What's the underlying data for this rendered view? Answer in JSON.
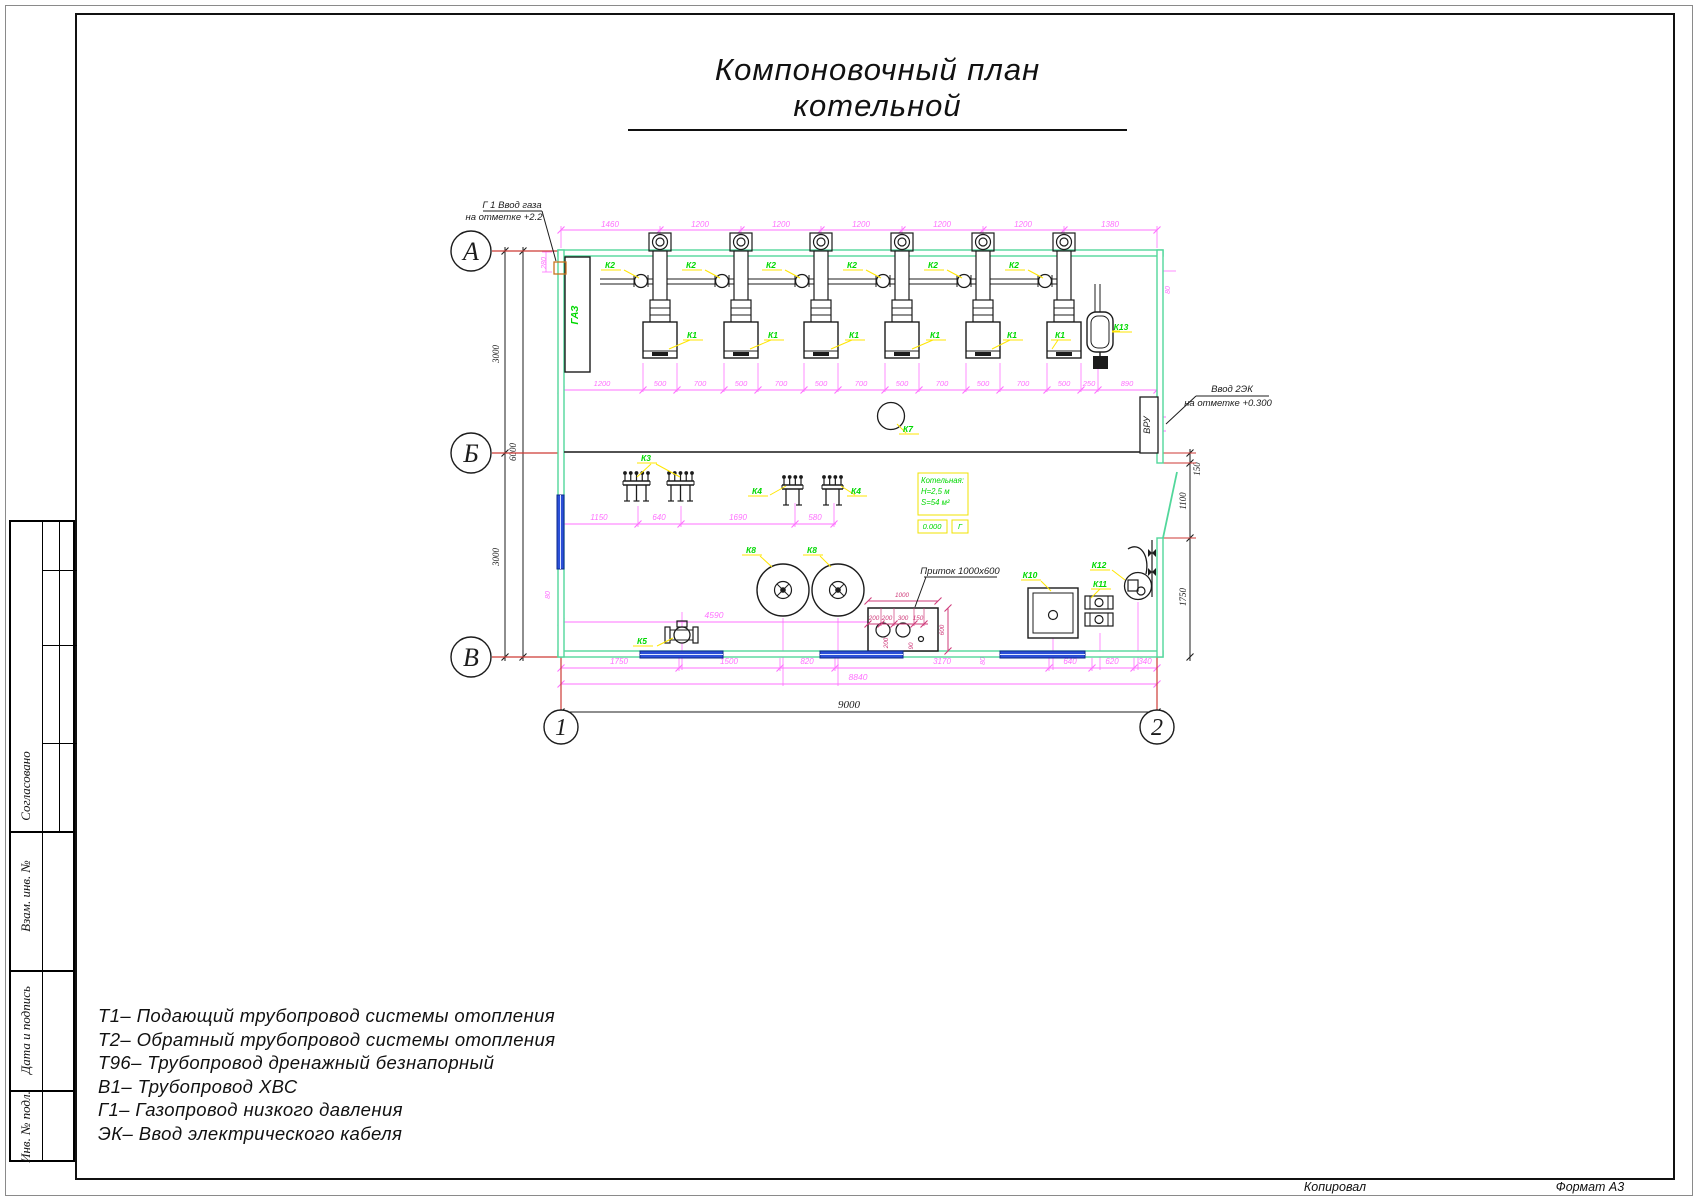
{
  "title": "Компоновочный план котельной",
  "axis_labels": {
    "rows": [
      "А",
      "Б",
      "В"
    ],
    "cols": [
      "1",
      "2"
    ]
  },
  "annotations": {
    "gas_line1": "Г 1 Ввод газа",
    "gas_line2": "на отметке +2.2",
    "cable_line1": "Ввод 2ЭК",
    "cable_line2": "на отметке +0.300",
    "intake": "Приток 1000х600",
    "gaz_cabinet": "ГАЗ",
    "vru": "ВРУ"
  },
  "room_info": {
    "name": "Котельная:",
    "height": "Н=2,5 м",
    "area": "S=54 м²",
    "level": "0.000",
    "letter": "Г"
  },
  "dims": {
    "top": [
      {
        "v": "1460",
        "x": 610
      },
      {
        "v": "1200",
        "x": 700
      },
      {
        "v": "1200",
        "x": 781
      },
      {
        "v": "1200",
        "x": 861
      },
      {
        "v": "1200",
        "x": 942
      },
      {
        "v": "1200",
        "x": 1023
      },
      {
        "v": "1380",
        "x": 1110
      }
    ],
    "boiler_row": [
      {
        "v": "1200",
        "x": 602
      },
      {
        "v": "500",
        "x": 660
      },
      {
        "v": "700",
        "x": 700
      },
      {
        "v": "500",
        "x": 741
      },
      {
        "v": "700",
        "x": 781
      },
      {
        "v": "500",
        "x": 821
      },
      {
        "v": "700",
        "x": 861
      },
      {
        "v": "500",
        "x": 902
      },
      {
        "v": "700",
        "x": 942
      },
      {
        "v": "500",
        "x": 983
      },
      {
        "v": "700",
        "x": 1023
      },
      {
        "v": "500",
        "x": 1064
      },
      {
        "v": "250",
        "x": 1089
      },
      {
        "v": "890",
        "x": 1127
      }
    ],
    "mid_row": [
      {
        "v": "1150",
        "x": 599
      },
      {
        "v": "640",
        "x": 659
      },
      {
        "v": "1690",
        "x": 738
      },
      {
        "v": "580",
        "x": 815
      }
    ],
    "single": [
      {
        "v": "4590",
        "x": 714,
        "y": 618
      },
      {
        "v": "8840",
        "x": 858,
        "y": 680
      }
    ],
    "bottom_row": [
      {
        "v": "1750",
        "x": 619
      },
      {
        "v": "1500",
        "x": 729
      },
      {
        "v": "820",
        "x": 807
      },
      {
        "v": "3170",
        "x": 942
      },
      {
        "v": "640",
        "x": 1070
      },
      {
        "v": "620",
        "x": 1112
      },
      {
        "v": "340",
        "x": 1145
      }
    ],
    "magenta_rot": [
      {
        "v": "280",
        "x": 546,
        "y": 263
      },
      {
        "v": "80",
        "x": 1170,
        "y": 290
      },
      {
        "v": "80",
        "x": 550,
        "y": 595
      },
      {
        "v": "80",
        "x": 985,
        "y": 661
      }
    ],
    "intake_dims": [
      {
        "v": "1000",
        "x": 902,
        "y": 597
      },
      {
        "v": "200",
        "x": 874,
        "y": 620
      },
      {
        "v": "200",
        "x": 887,
        "y": 620
      },
      {
        "v": "300",
        "x": 903,
        "y": 620
      },
      {
        "v": "150",
        "x": 918,
        "y": 620
      }
    ],
    "intake_rot": [
      {
        "v": "600",
        "x": 944,
        "y": 630
      },
      {
        "v": "200",
        "x": 888,
        "y": 643
      },
      {
        "v": "90",
        "x": 913,
        "y": 646
      }
    ],
    "black": [
      {
        "v": "9000",
        "x": 849,
        "y": 708
      }
    ],
    "black_rot": [
      {
        "v": "6000",
        "x": 516,
        "y": 452
      },
      {
        "v": "3000",
        "x": 499,
        "y": 354
      },
      {
        "v": "3000",
        "x": 499,
        "y": 557
      },
      {
        "v": "150",
        "x": 1200,
        "y": 469
      },
      {
        "v": "1100",
        "x": 1186,
        "y": 501
      },
      {
        "v": "1750",
        "x": 1186,
        "y": 597
      }
    ]
  },
  "equipment_labels": [
    {
      "t": "К2",
      "x": 610,
      "y": 266,
      "l": [
        639,
        278,
        624,
        270
      ]
    },
    {
      "t": "К2",
      "x": 691,
      "y": 266,
      "l": [
        720,
        278,
        705,
        270
      ]
    },
    {
      "t": "К2",
      "x": 771,
      "y": 266,
      "l": [
        800,
        278,
        785,
        270
      ]
    },
    {
      "t": "К2",
      "x": 852,
      "y": 266,
      "l": [
        881,
        278,
        866,
        270
      ]
    },
    {
      "t": "К2",
      "x": 933,
      "y": 266,
      "l": [
        962,
        278,
        947,
        270
      ]
    },
    {
      "t": "К2",
      "x": 1014,
      "y": 266,
      "l": [
        1043,
        278,
        1028,
        270
      ]
    },
    {
      "t": "К1",
      "x": 692,
      "y": 336,
      "l": [
        669,
        349,
        690,
        340
      ]
    },
    {
      "t": "К1",
      "x": 773,
      "y": 336,
      "l": [
        750,
        349,
        771,
        340
      ]
    },
    {
      "t": "К1",
      "x": 854,
      "y": 336,
      "l": [
        831,
        349,
        852,
        340
      ]
    },
    {
      "t": "К1",
      "x": 935,
      "y": 336,
      "l": [
        912,
        349,
        933,
        340
      ]
    },
    {
      "t": "К1",
      "x": 1012,
      "y": 336,
      "l": [
        992,
        349,
        1010,
        340
      ]
    },
    {
      "t": "К1",
      "x": 1060,
      "y": 336,
      "l": [
        1052,
        349,
        1058,
        340
      ]
    },
    {
      "t": "К3",
      "x": 646,
      "y": 459,
      "l": [
        651,
        464,
        637,
        477
      ],
      "l2": [
        656,
        464,
        680,
        477
      ]
    },
    {
      "t": "К4",
      "x": 757,
      "y": 492,
      "l": [
        770,
        495,
        786,
        486
      ]
    },
    {
      "t": "К4",
      "x": 856,
      "y": 492,
      "l": [
        855,
        495,
        841,
        486
      ]
    },
    {
      "t": "К5",
      "x": 642,
      "y": 642,
      "l": [
        657,
        646,
        673,
        638
      ]
    },
    {
      "t": "К7",
      "x": 908,
      "y": 430,
      "l": [
        906,
        433,
        897,
        424
      ]
    },
    {
      "t": "К8",
      "x": 751,
      "y": 551,
      "l": [
        760,
        556,
        772,
        567
      ]
    },
    {
      "t": "К8",
      "x": 812,
      "y": 551,
      "l": [
        820,
        556,
        831,
        567
      ]
    },
    {
      "t": "К10",
      "x": 1030,
      "y": 576,
      "l": [
        1041,
        581,
        1051,
        591
      ]
    },
    {
      "t": "К11",
      "x": 1100,
      "y": 585,
      "l": [
        1100,
        589,
        1091,
        598
      ]
    },
    {
      "t": "К12",
      "x": 1099,
      "y": 566,
      "l": [
        1112,
        570,
        1125,
        580
      ]
    },
    {
      "t": "К13",
      "x": 1121,
      "y": 328,
      "l": [
        1120,
        331,
        1112,
        331
      ]
    }
  ],
  "legend": [
    "Т1– Подающий трубопровод системы отопления",
    "Т2– Обратный трубопровод системы отопления",
    "Т96– Трубопровод дренажный безнапорный",
    "В1– Трубопровод ХВС",
    "Г1– Газопровод низкого давления",
    "ЭК– Ввод электрического кабеля"
  ],
  "sidebar": [
    "Согласовано",
    "Взам. инв. №",
    "Дата и подпись",
    "Инв. № подл."
  ],
  "footer": {
    "copied": "Копировал",
    "format": "Формат А3"
  },
  "colors": {
    "wall": "#52d79b",
    "dim": "#ff70ff",
    "label": "#00d800",
    "leader": "#ffe600",
    "red": "#cd3a35",
    "blue": "#2b50d8",
    "intake_dim": "#cf3b7a",
    "yellow": "#f0e300",
    "ink": "#1c1c1c"
  }
}
